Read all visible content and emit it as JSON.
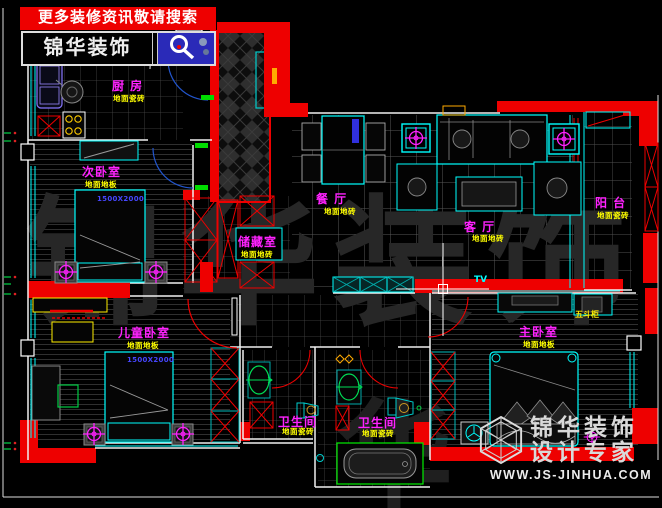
{
  "header": {
    "banner_text": "更多装修资讯敬请搜索",
    "brand_name": "锦华装饰"
  },
  "rooms": {
    "kitchen": {
      "label": "厨 房",
      "note": "地面瓷砖"
    },
    "bedroom2": {
      "label": "次卧室",
      "note": "地面地板"
    },
    "dining": {
      "label": "餐 厅",
      "note": "地面地砖"
    },
    "storage": {
      "label": "储藏室",
      "note": "地面地砖"
    },
    "living": {
      "label": "客 厅",
      "note": "地面地砖"
    },
    "balcony": {
      "label": "阳 台",
      "note": "地面瓷砖"
    },
    "kids_bedroom": {
      "label": "儿童卧室",
      "note": "地面地板"
    },
    "bath1": {
      "label": "卫生间",
      "note": "地面瓷砖"
    },
    "bath2": {
      "label": "卫生间",
      "note": "地面瓷砖"
    },
    "master_bedroom": {
      "label": "主卧室",
      "note": "地面地板"
    }
  },
  "annotations": {
    "bed_dim_bedroom2": "1500X2000",
    "bed_dim_kids": "1500X2000",
    "chest_label": "五斗柜",
    "tv_label": "TV"
  },
  "watermark": {
    "brand": "锦华装饰",
    "tagline": "设计专家",
    "website": "WWW.JS-JINHUA.COM",
    "background_text": "锦华装饰",
    "background_text2": "华"
  },
  "colors": {
    "wall_red": "#ee0000",
    "line_cyan": "#00ffff",
    "label_magenta": "#ff22ff",
    "note_yellow": "#ffff00",
    "dim_blue": "#4646ff",
    "search_box_blue": "#2a2ab8"
  }
}
